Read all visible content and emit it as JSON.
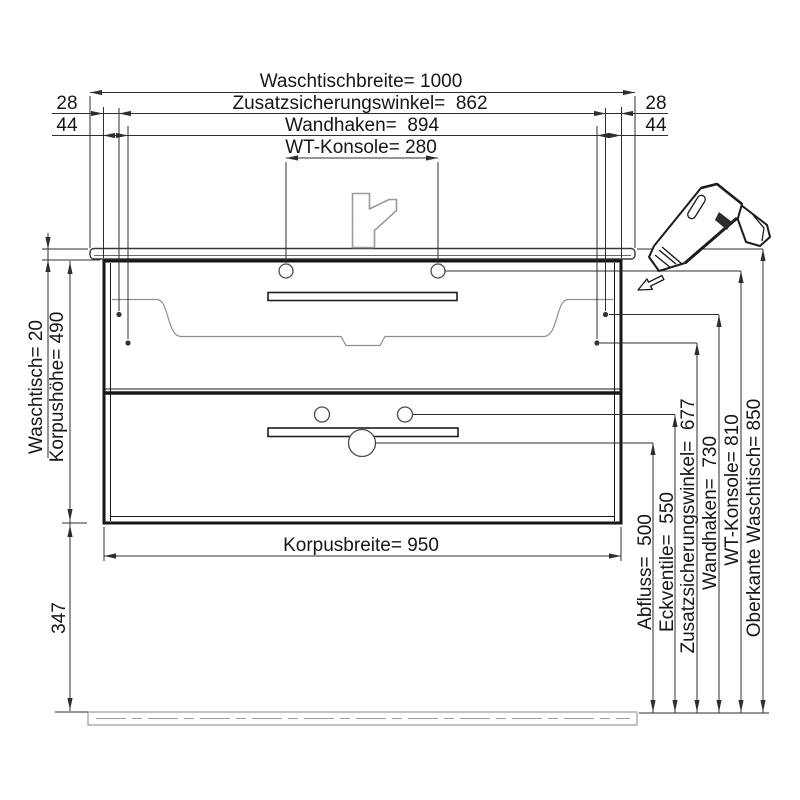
{
  "drawing": {
    "type": "technical-installation-drawing",
    "subject": "bathroom vanity with washbasin, front view with mounting dimensions"
  },
  "dimensions_top": {
    "waschtischbreite": "Waschtischbreite= 1000",
    "zusatzsicherungswinkel": "Zusatzsicherungswinkel=  862",
    "wandhaken": "Wandhaken=  894",
    "wt_konsole": "WT-Konsole= 280",
    "offset_left_28": "28",
    "offset_left_44": "44",
    "offset_right_28": "28",
    "offset_right_44": "44"
  },
  "dimensions_left": {
    "waschtisch": "Waschtisch= 20",
    "korpushoehe": "Korpushöhe= 490",
    "bottom_clearance": "347"
  },
  "dimensions_bottom": {
    "korpusbreite": "Korpusbreite= 950"
  },
  "dimensions_right": {
    "abfluss": "Abfluss=  500",
    "eckventile": "Eckventile=  550",
    "zusatzsicherungswinkel": "Zusatzsicherungswinkel=  677",
    "wandhaken": "Wandhaken=  730",
    "wt_konsole": "WT-Konsole= 810",
    "oberkante_waschtisch": "Oberkante Waschtisch= 850"
  },
  "icons": {
    "drill": "cordless-screwdriver-icon",
    "faucet": "faucet-icon",
    "direction_arrow": "arrow-down-left-icon"
  },
  "colors": {
    "background": "#ffffff",
    "line": "#2e2e2e",
    "heavy_line": "#161616",
    "light_line": "#9a9a9a",
    "text": "#161616"
  }
}
